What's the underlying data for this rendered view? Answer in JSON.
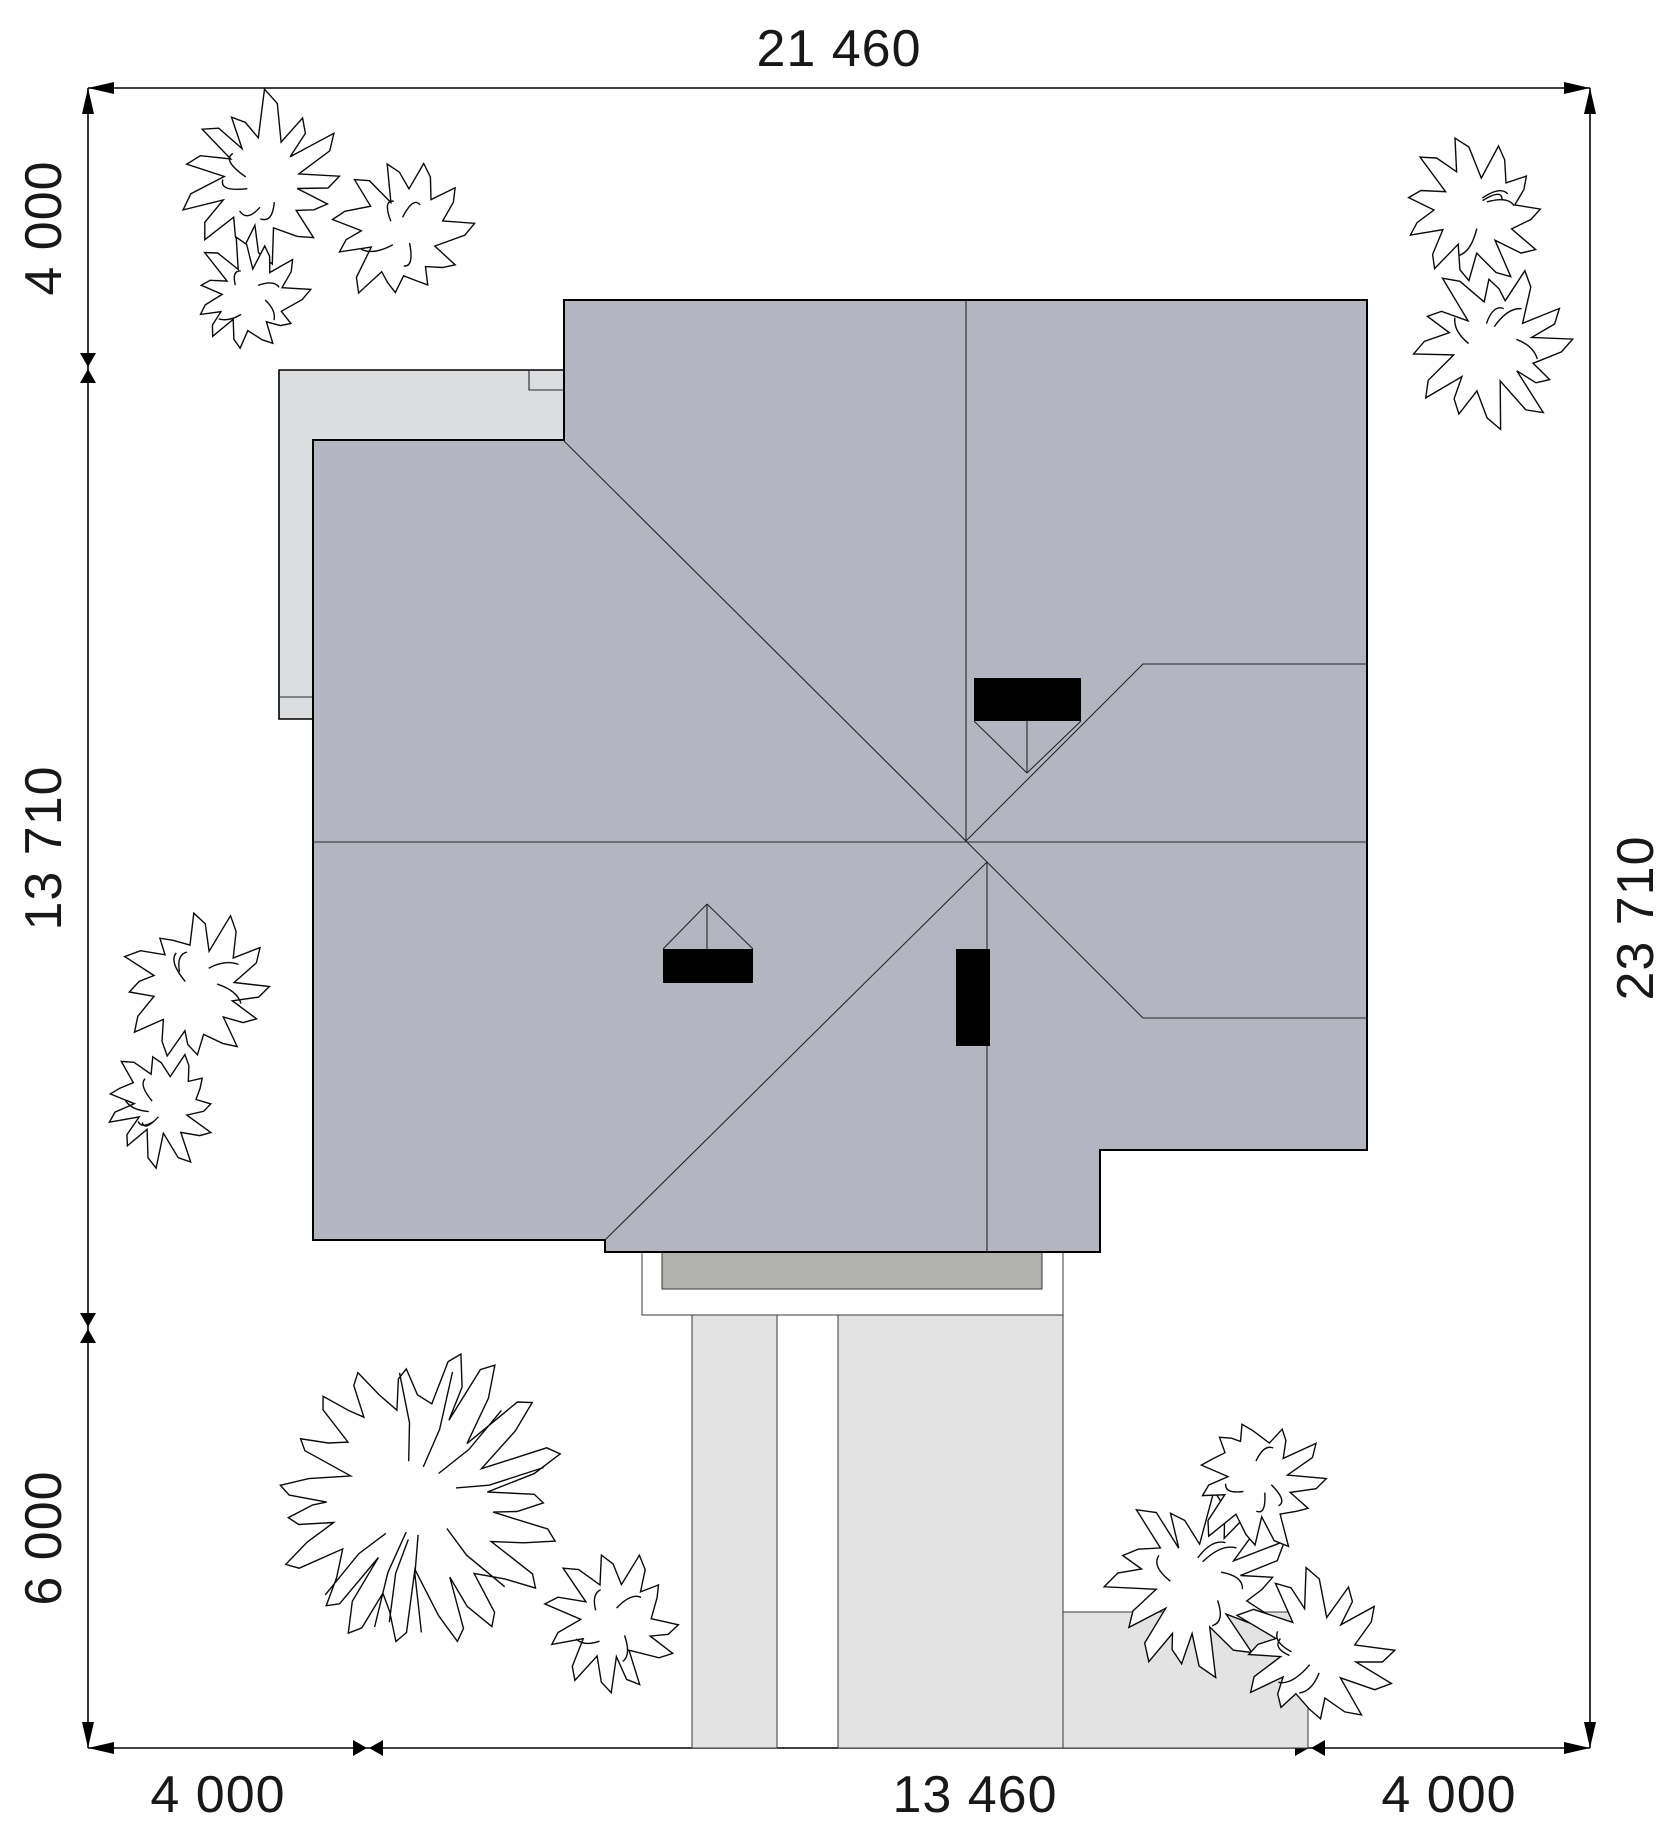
{
  "dimensions": {
    "top": "21 460",
    "left": [
      "4 000",
      "13 710",
      "6 000"
    ],
    "right": "23 710",
    "bottom": [
      "4 000",
      "13 460",
      "4 000"
    ]
  },
  "colors": {
    "roof": "#b3b5c1",
    "terrace": "#dcdddf",
    "slab": "#b1b2ad",
    "path": "#e3e3e3",
    "chimney": "#000000",
    "outline": "#000000"
  }
}
